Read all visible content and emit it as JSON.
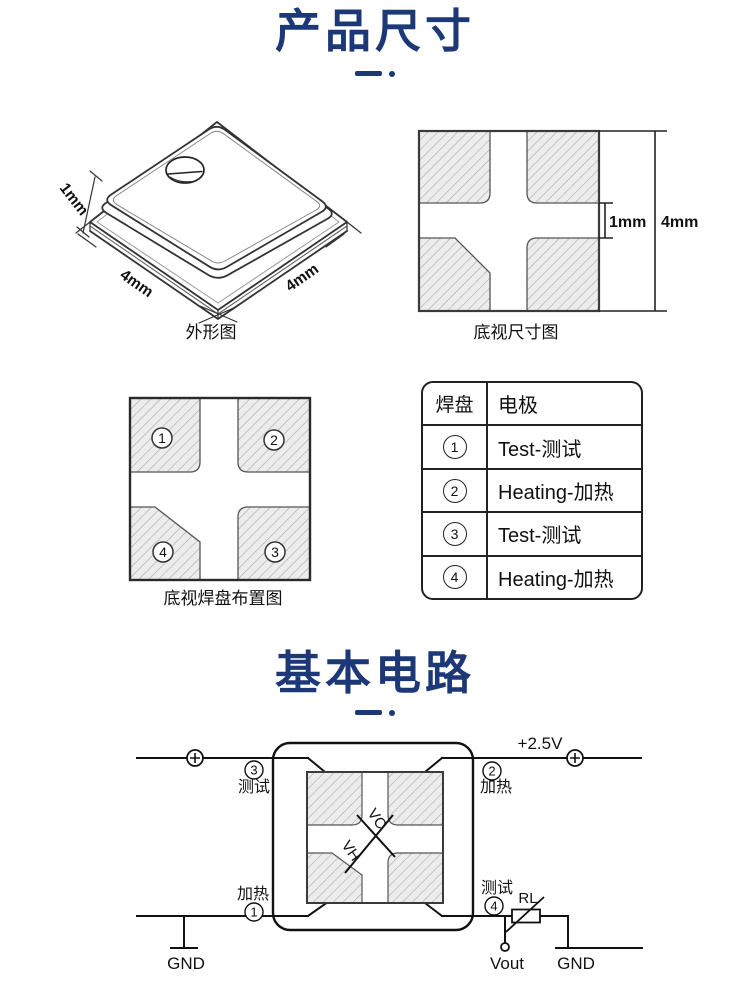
{
  "page": {
    "section1_title": "产品尺寸",
    "section2_title": "基本电路",
    "accent_color": "#1c3876"
  },
  "outline_figure": {
    "caption": "外形图",
    "dim_thickness": "1mm",
    "dim_width_left": "4mm",
    "dim_width_right": "4mm"
  },
  "bottom_view_figure": {
    "caption": "底视尺寸图",
    "dim_gap": "1mm",
    "dim_side": "4mm"
  },
  "pad_layout_figure": {
    "caption": "底视焊盘布置图",
    "pad1": "1",
    "pad2": "2",
    "pad3": "3",
    "pad4": "4"
  },
  "pad_table": {
    "header_pad": "焊盘",
    "header_electrode": "电极",
    "rows": [
      {
        "pad": "1",
        "electrode": "Test-测试"
      },
      {
        "pad": "2",
        "electrode": "Heating-加热"
      },
      {
        "pad": "3",
        "electrode": "Test-测试"
      },
      {
        "pad": "4",
        "electrode": "Heating-加热"
      }
    ]
  },
  "circuit": {
    "supply": "+2.5V",
    "vout": "Vout",
    "gnd_left": "GND",
    "gnd_right": "GND",
    "rl": "RL",
    "vc": "VC",
    "vh": "VH",
    "pin1_num": "1",
    "pin1_label": "加热",
    "pin2_num": "2",
    "pin2_label": "加热",
    "pin3_num": "3",
    "pin3_label": "测试",
    "pin4_num": "4",
    "pin4_label": "测试"
  }
}
